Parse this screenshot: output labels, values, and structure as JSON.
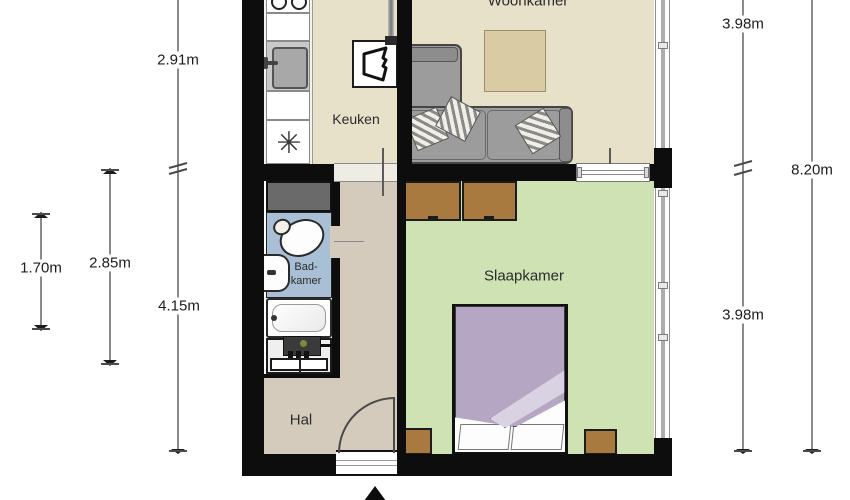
{
  "plan": {
    "type": "apartment-floor-plan",
    "rooms": {
      "woonkamer": {
        "label": "Woonkamer"
      },
      "keuken": {
        "label": "Keuken"
      },
      "slaapkamer": {
        "label": "Slaapkamer"
      },
      "hal": {
        "label": "Hal"
      },
      "badkamer": {
        "label_line1": "Bad-",
        "label_line2": "kamer"
      }
    },
    "dimensions": {
      "left": [
        {
          "label": "2.91m"
        },
        {
          "label": "1.70m"
        },
        {
          "label": "2.85m"
        },
        {
          "label": "4.15m"
        }
      ],
      "right": [
        {
          "label": "3.98m"
        },
        {
          "label": "8.20m"
        },
        {
          "label": "3.98m"
        }
      ]
    },
    "icons": {
      "freezer_glyph": "✳"
    },
    "colors": {
      "living_floor": "#e8e1ca",
      "hall_floor": "#d5cbbd",
      "bedroom_floor": "#cfe2b3",
      "bathroom_floor": "#a9bfd5",
      "wall": "#0d0d0d",
      "wood": "#a97a40",
      "sofa": "#9c9c9c",
      "duvet": "#b5a7c4"
    }
  }
}
